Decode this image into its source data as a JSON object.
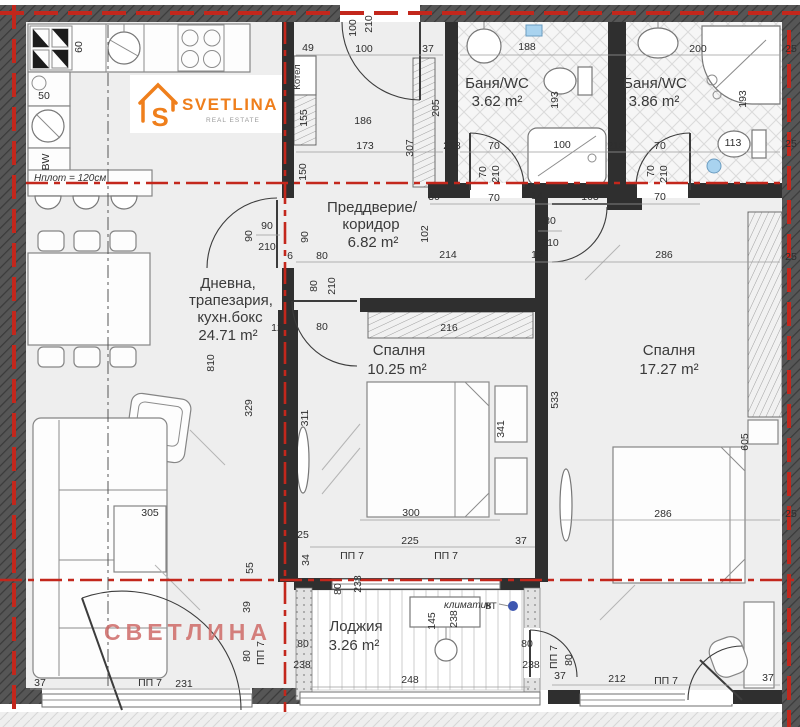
{
  "logo": {
    "brand": "SVETLINA",
    "tagline": "REAL ESTATE",
    "mark": "S"
  },
  "watermark": "СВЕТЛИНА",
  "rooms": [
    {
      "id": "living",
      "name_lines": [
        "Дневна,",
        "трапезария,",
        "кухн.бокс"
      ],
      "area": "24.71 m²"
    },
    {
      "id": "hall",
      "name_lines": [
        "Преддверие/",
        "коридор"
      ],
      "area": "6.82 m²"
    },
    {
      "id": "bath-1",
      "name_lines": [
        "Баня/WC"
      ],
      "area": "3.62 m²"
    },
    {
      "id": "bath-2",
      "name_lines": [
        "Баня/WC"
      ],
      "area": "3.86 m²"
    },
    {
      "id": "bedroom-1",
      "name_lines": [
        "Спалня"
      ],
      "area": "10.25 m²"
    },
    {
      "id": "bedroom-2",
      "name_lines": [
        "Спалня"
      ],
      "area": "17.27 m²"
    },
    {
      "id": "loggia",
      "name_lines": [
        "Лоджия"
      ],
      "area": "3.26 m²"
    }
  ],
  "labels": {
    "boiler": "Котел",
    "counter_height": "Hплот = 120см",
    "ac_unit": "климатик",
    "vt": "ВТ"
  },
  "dims": [
    {
      "v": "60",
      "x": 82,
      "y": 47,
      "r": -90
    },
    {
      "v": "50",
      "x": 44,
      "y": 99
    },
    {
      "v": "BW",
      "x": 49,
      "y": 162,
      "r": -90
    },
    {
      "v": "49",
      "x": 308,
      "y": 51
    },
    {
      "v": "100",
      "x": 364,
      "y": 52
    },
    {
      "v": "37",
      "x": 428,
      "y": 52
    },
    {
      "v": "100",
      "x": 356,
      "y": 28,
      "r": -90
    },
    {
      "v": "210",
      "x": 372,
      "y": 24,
      "r": -90
    },
    {
      "v": "188",
      "x": 527,
      "y": 50
    },
    {
      "v": "200",
      "x": 698,
      "y": 52
    },
    {
      "v": "25",
      "x": 791,
      "y": 52
    },
    {
      "v": "155",
      "x": 307,
      "y": 118,
      "r": -90
    },
    {
      "v": "205",
      "x": 439,
      "y": 108,
      "r": -90
    },
    {
      "v": "193",
      "x": 558,
      "y": 100,
      "r": -90
    },
    {
      "v": "193",
      "x": 746,
      "y": 99,
      "r": -90
    },
    {
      "v": "150",
      "x": 306,
      "y": 172,
      "r": -90
    },
    {
      "v": "307",
      "x": 413,
      "y": 148,
      "r": -90
    },
    {
      "v": "186",
      "x": 363,
      "y": 124
    },
    {
      "v": "173",
      "x": 365,
      "y": 149
    },
    {
      "v": "218",
      "x": 452,
      "y": 149
    },
    {
      "v": "70",
      "x": 494,
      "y": 149
    },
    {
      "v": "100",
      "x": 562,
      "y": 148
    },
    {
      "v": "218",
      "x": 616,
      "y": 149
    },
    {
      "v": "70",
      "x": 660,
      "y": 149
    },
    {
      "v": "113",
      "x": 733,
      "y": 146
    },
    {
      "v": "25",
      "x": 791,
      "y": 147
    },
    {
      "v": "70",
      "x": 486,
      "y": 172,
      "r": -90
    },
    {
      "v": "210",
      "x": 499,
      "y": 174,
      "r": -90
    },
    {
      "v": "70",
      "x": 654,
      "y": 171,
      "r": -90
    },
    {
      "v": "210",
      "x": 667,
      "y": 174,
      "r": -90
    },
    {
      "v": "30",
      "x": 434,
      "y": 200
    },
    {
      "v": "70",
      "x": 494,
      "y": 201
    },
    {
      "v": "14",
      "x": 537,
      "y": 199
    },
    {
      "v": "103",
      "x": 590,
      "y": 200
    },
    {
      "v": "70",
      "x": 660,
      "y": 200
    },
    {
      "v": "90",
      "x": 308,
      "y": 237,
      "r": -90
    },
    {
      "v": "90",
      "x": 252,
      "y": 236,
      "r": -90
    },
    {
      "v": "90",
      "x": 267,
      "y": 229
    },
    {
      "v": "210",
      "x": 267,
      "y": 250
    },
    {
      "v": "102",
      "x": 428,
      "y": 234,
      "r": -90
    },
    {
      "v": "214",
      "x": 448,
      "y": 258
    },
    {
      "v": "12",
      "x": 537,
      "y": 258
    },
    {
      "v": "286",
      "x": 664,
      "y": 258
    },
    {
      "v": "80",
      "x": 550,
      "y": 224
    },
    {
      "v": "210",
      "x": 550,
      "y": 246
    },
    {
      "v": "80",
      "x": 322,
      "y": 259
    },
    {
      "v": "80",
      "x": 317,
      "y": 286,
      "r": -90
    },
    {
      "v": "210",
      "x": 335,
      "y": 286,
      "r": -90
    },
    {
      "v": "80",
      "x": 322,
      "y": 330
    },
    {
      "v": "12",
      "x": 277,
      "y": 331
    },
    {
      "v": "6",
      "x": 290,
      "y": 259
    },
    {
      "v": "216",
      "x": 449,
      "y": 331
    },
    {
      "v": "311",
      "x": 308,
      "y": 418,
      "r": -90
    },
    {
      "v": "341",
      "x": 504,
      "y": 429,
      "r": -90
    },
    {
      "v": "300",
      "x": 411,
      "y": 516
    },
    {
      "v": "329",
      "x": 252,
      "y": 408,
      "r": -90
    },
    {
      "v": "810",
      "x": 214,
      "y": 363,
      "r": -90
    },
    {
      "v": "25",
      "x": 303,
      "y": 538
    },
    {
      "v": "34",
      "x": 309,
      "y": 560,
      "r": -90
    },
    {
      "v": "225",
      "x": 410,
      "y": 544
    },
    {
      "v": "37",
      "x": 521,
      "y": 544
    },
    {
      "v": "533",
      "x": 558,
      "y": 400,
      "r": -90
    },
    {
      "v": "286",
      "x": 663,
      "y": 517
    },
    {
      "v": "605",
      "x": 748,
      "y": 442,
      "r": -90
    },
    {
      "v": "25",
      "x": 791,
      "y": 260
    },
    {
      "v": "25",
      "x": 791,
      "y": 517
    },
    {
      "v": "305",
      "x": 150,
      "y": 516
    },
    {
      "v": "55",
      "x": 253,
      "y": 568,
      "r": -90
    },
    {
      "v": "39",
      "x": 250,
      "y": 607,
      "r": -90
    },
    {
      "v": "37",
      "x": 40,
      "y": 686
    },
    {
      "v": "ПП 7",
      "x": 150,
      "y": 686
    },
    {
      "v": "231",
      "x": 184,
      "y": 687
    },
    {
      "v": "ПП 7",
      "x": 352,
      "y": 559
    },
    {
      "v": "ПП 7",
      "x": 446,
      "y": 559
    },
    {
      "v": "80",
      "x": 341,
      "y": 589,
      "r": -90
    },
    {
      "v": "238",
      "x": 361,
      "y": 584,
      "r": -90
    },
    {
      "v": "145",
      "x": 435,
      "y": 621,
      "r": -90
    },
    {
      "v": "238",
      "x": 457,
      "y": 619,
      "r": -90
    },
    {
      "v": "248",
      "x": 410,
      "y": 683
    },
    {
      "v": "80",
      "x": 303,
      "y": 647
    },
    {
      "v": "238",
      "x": 302,
      "y": 668
    },
    {
      "v": "80",
      "x": 527,
      "y": 647
    },
    {
      "v": "238",
      "x": 531,
      "y": 668
    },
    {
      "v": "ПП 7",
      "x": 264,
      "y": 653,
      "r": -90
    },
    {
      "v": "80",
      "x": 250,
      "y": 656,
      "r": -90
    },
    {
      "v": "ПП 7",
      "x": 557,
      "y": 657,
      "r": -90
    },
    {
      "v": "80",
      "x": 572,
      "y": 660,
      "r": -90
    },
    {
      "v": "37",
      "x": 560,
      "y": 679
    },
    {
      "v": "212",
      "x": 617,
      "y": 682
    },
    {
      "v": "ПП 7",
      "x": 666,
      "y": 684
    },
    {
      "v": "37",
      "x": 768,
      "y": 681
    }
  ],
  "colors": {
    "axis-red": "#c3271c",
    "logo-orange": "#ef7f1c",
    "watermark-pink": "#cf6b68",
    "accent-blue": "#a9d3ef",
    "wall-grey": "#565656"
  }
}
